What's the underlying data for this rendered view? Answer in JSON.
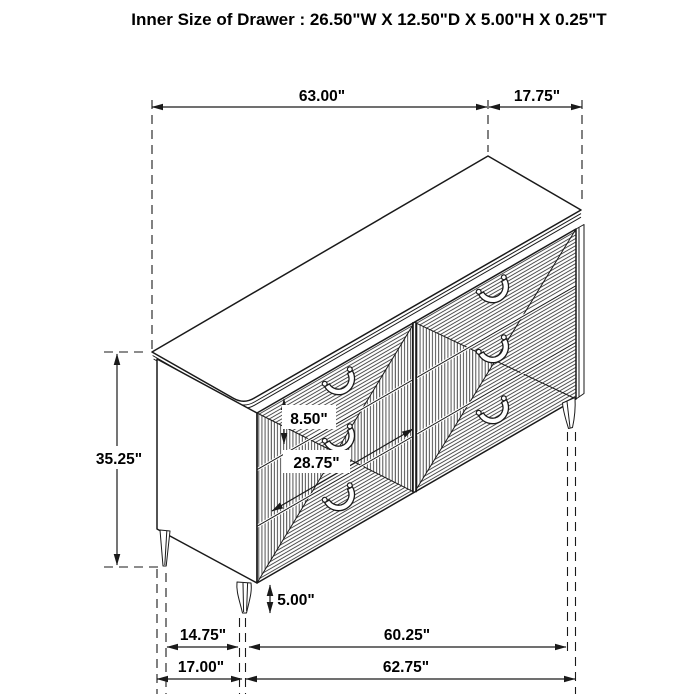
{
  "title": "Inner Size of Drawer : 26.50\"W X 12.50\"D X 5.00\"H X 0.25\"T",
  "figure": {
    "name": "dresser-isometric-dimension-drawing",
    "line_color": "#1a1a1a",
    "background": "#ffffff"
  },
  "dimensions": {
    "overall_width": "63.00\"",
    "overall_depth": "17.75\"",
    "overall_height": "35.25\"",
    "drawer_front_height": "8.50\"",
    "drawer_front_width": "28.75\"",
    "leg_height": "5.00\"",
    "leg_span_depth": "14.75\"",
    "leg_span_width": "60.25\"",
    "base_depth": "17.00\"",
    "base_width": "62.75\""
  }
}
